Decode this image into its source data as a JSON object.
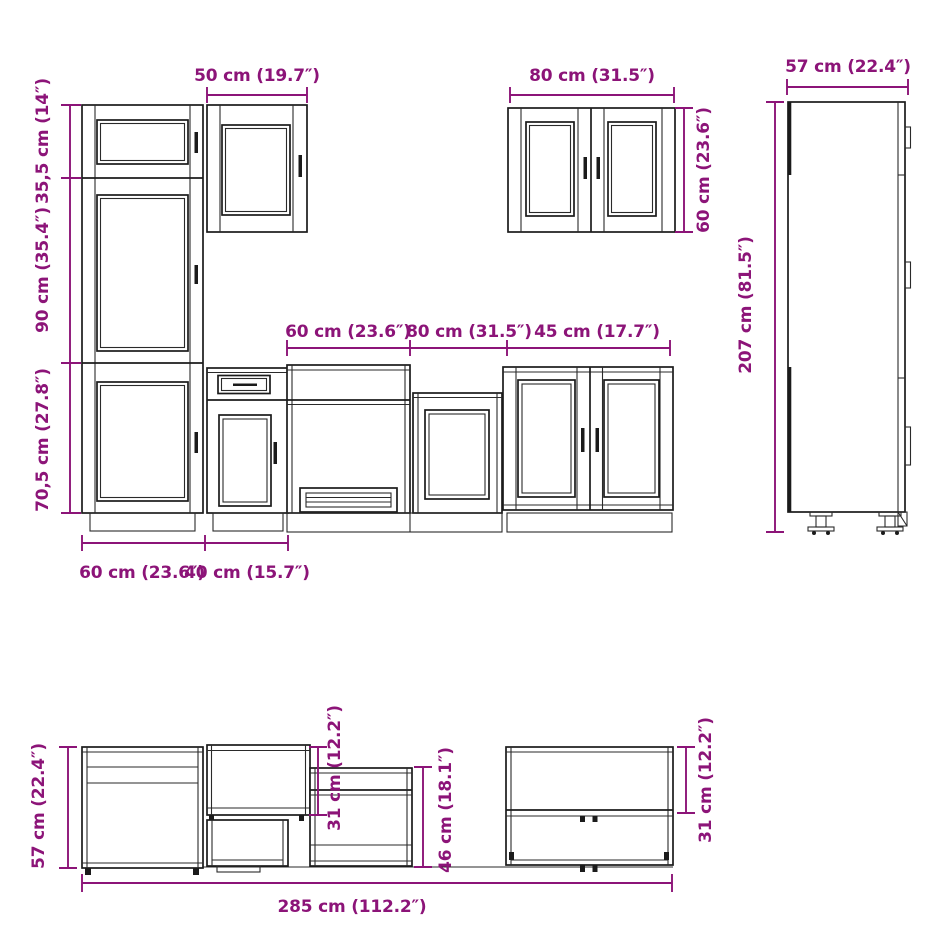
{
  "diagram": {
    "kind": "kitchen-cabinet-set-technical-drawing",
    "accent_color": "#8C1478",
    "line_color": "#1b1b1b",
    "background_color": "#ffffff"
  },
  "dimensions": {
    "front": {
      "wall_cab_50_width": "50 cm (19.7″)",
      "tall_top_height": "35,5 cm (14″)",
      "tall_mid_height": "90 cm (35.4″)",
      "tall_bottom_height": "70,5 cm (27.8″)",
      "tall_unit_width": "60 cm (23.6″)",
      "base_40_width": "40 cm (15.7″)",
      "oven_unit_width": "60 cm (23.6″)",
      "mid_unit_width": "80 cm (31.5″)",
      "double_unit_width": "45 cm (17.7″)",
      "wall_cab_80_width": "80 cm (31.5″)",
      "wall_cab_80_height": "60 cm (23.6″)",
      "tall_side_depth": "57 cm (22.4″)",
      "tall_side_height": "207 cm (81.5″)"
    },
    "side": {
      "base_cab_height": "57 cm (22.4″)",
      "wall_cab_height_left": "31 cm (12.2″)",
      "mid_unit_height": "46 cm (18.1″)",
      "wall_cab_height_right": "31 cm (12.2″)",
      "total_run_width": "285 cm (112.2″)"
    }
  }
}
